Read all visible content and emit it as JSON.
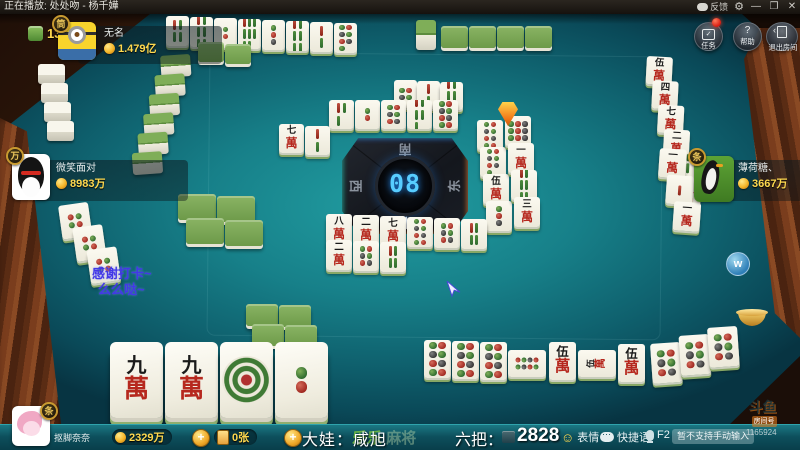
{
  "titlebar": {
    "now_playing": "正在播放: 处处吻 - 杨千嬅",
    "feedback_label": "反馈",
    "minimize": "—",
    "maximize": "❐",
    "close": "✕"
  },
  "menu_buttons": {
    "tasks": "任务",
    "help": "帮助",
    "help_icon": "?",
    "exit": "退出房间"
  },
  "tile_counter": "13",
  "players": {
    "top": {
      "badge": "筒",
      "name": "无名",
      "money": "1.479亿"
    },
    "left": {
      "badge": "万",
      "name": "微笑面对",
      "money": "8983万"
    },
    "right": {
      "badge": "条",
      "name": "薄荷糖、",
      "money": "3667万"
    },
    "bottom": {
      "badge": "条",
      "name": "抠脚奈奈",
      "money": "2329万",
      "cards": "0张"
    }
  },
  "center": {
    "timer": "08",
    "south": "南",
    "north": "北",
    "west": "西",
    "east": "东"
  },
  "chat": {
    "line1": "感谢打卡~",
    "line2": "么么哒~"
  },
  "bottom_bar": {
    "dealer": "大娃：咸旭",
    "round_label": "六把：",
    "round_value": "2828",
    "emoji": "表情",
    "quick": "快捷语",
    "mic_key": "F2",
    "input_placeholder": "暂不支持手动输入",
    "watermark_a": "乐乐",
    "watermark_b": "麻将"
  },
  "douyu": {
    "logo": "斗鱼",
    "room_label": "房间号",
    "room_number": "1165924"
  },
  "side_icons": {
    "w_label": "w"
  },
  "colors": {
    "money_text": "#ffd94f",
    "table": "#178089",
    "led": "#57cdff",
    "wood": "#7a3d1d",
    "chat_blue": "#4338e6",
    "tile_back_green": "#6d9a49"
  },
  "tile_groups": [
    {
      "name": "top-meld-row",
      "x": 166,
      "y": 16,
      "tw": 23,
      "th": 30,
      "step": [
        24,
        1
      ],
      "style": "flat",
      "faces": [
        "s4",
        "s6",
        "t2",
        "s8",
        "t3",
        "s6",
        "s2",
        "t7"
      ]
    },
    {
      "name": "top-backs-small",
      "x": 198,
      "y": 42,
      "tw": 26,
      "th": 20,
      "step": [
        27,
        2
      ],
      "style": "backflat",
      "faces": [
        "back",
        "back"
      ]
    },
    {
      "name": "top-stand-back",
      "x": 416,
      "y": 20,
      "tw": 20,
      "th": 30,
      "step": [
        0,
        0
      ],
      "style": "backstand",
      "faces": [
        "back"
      ]
    },
    {
      "name": "top-flat-backs",
      "x": 441,
      "y": 26,
      "tw": 27,
      "th": 22,
      "step": [
        28,
        0
      ],
      "style": "backflat",
      "faces": [
        "back",
        "back",
        "back",
        "back"
      ]
    },
    {
      "name": "left-white-wall",
      "x": 38,
      "y": 64,
      "tw": 27,
      "th": 20,
      "step": [
        3,
        19
      ],
      "style": "standwhite",
      "faces": [
        "back",
        "back",
        "back",
        "back"
      ]
    },
    {
      "name": "left-wall",
      "x": 160,
      "y": 56,
      "tw": 30,
      "th": 22,
      "step": [
        -7,
        19
      ],
      "style": "backstand",
      "faces": [
        "back",
        "back",
        "back",
        "back",
        "back",
        "back"
      ],
      "rot": -4
    },
    {
      "name": "left-melds",
      "x": 58,
      "y": 206,
      "tw": 30,
      "th": 34,
      "step": [
        11,
        24
      ],
      "style": "flat",
      "faces": [
        "f",
        "f",
        "f"
      ],
      "rot": -8
    },
    {
      "name": "left-green-a",
      "x": 178,
      "y": 194,
      "tw": 38,
      "th": 26,
      "step": [
        39,
        2
      ],
      "style": "backflat",
      "faces": [
        "back",
        "back"
      ]
    },
    {
      "name": "left-green-b",
      "x": 186,
      "y": 218,
      "tw": 38,
      "th": 26,
      "step": [
        39,
        2
      ],
      "style": "backflat",
      "faces": [
        "back",
        "back"
      ]
    },
    {
      "name": "bottom-green-a",
      "x": 246,
      "y": 304,
      "tw": 32,
      "th": 22,
      "step": [
        33,
        1
      ],
      "style": "backflat",
      "faces": [
        "back",
        "back"
      ]
    },
    {
      "name": "bottom-green-b",
      "x": 252,
      "y": 324,
      "tw": 32,
      "th": 22,
      "step": [
        33,
        1
      ],
      "style": "backflat",
      "faces": [
        "back",
        "back"
      ]
    },
    {
      "name": "top-discards-a",
      "x": 394,
      "y": 80,
      "tw": 23,
      "th": 28,
      "step": [
        23,
        1
      ],
      "style": "flat",
      "faces": [
        "t4",
        "s2",
        "s5"
      ]
    },
    {
      "name": "top-discards-b",
      "x": 329,
      "y": 100,
      "tw": 25,
      "th": 29,
      "step": [
        26,
        0
      ],
      "style": "flat",
      "faces": [
        "s3",
        "t2",
        "t6",
        "s5",
        "t8"
      ]
    },
    {
      "name": "mid-left-pair",
      "x": 279,
      "y": 124,
      "tw": 25,
      "th": 29,
      "step": [
        26,
        2
      ],
      "style": "flat",
      "faces": [
        "w7",
        "s2"
      ]
    },
    {
      "name": "center-right-col-a",
      "x": 477,
      "y": 120,
      "tw": 26,
      "th": 30,
      "step": [
        3,
        27
      ],
      "style": "flat",
      "faces": [
        "t8",
        "t7",
        "w5",
        "t3"
      ]
    },
    {
      "name": "center-right-col-b",
      "x": 505,
      "y": 116,
      "tw": 26,
      "th": 30,
      "step": [
        3,
        27
      ],
      "style": "flat",
      "faces": [
        "t9",
        "w1",
        "s6",
        "w3"
      ]
    },
    {
      "name": "right-river",
      "x": 647,
      "y": 56,
      "tw": 26,
      "th": 28,
      "step": [
        7,
        24
      ],
      "style": "flat",
      "faces": [
        "w5",
        "w4",
        "w7",
        "w2",
        "s8",
        "w6"
      ],
      "rot": 3
    },
    {
      "name": "right-river-low",
      "x": 660,
      "y": 148,
      "tw": 27,
      "th": 29,
      "step": [
        9,
        26
      ],
      "style": "flat",
      "faces": [
        "w1",
        "s1",
        "w1"
      ],
      "rot": 4
    },
    {
      "name": "below-center-a",
      "x": 326,
      "y": 214,
      "tw": 26,
      "th": 30,
      "step": [
        27,
        1
      ],
      "style": "flat",
      "faces": [
        "w8",
        "w2",
        "w7",
        "t8",
        "t6",
        "s4"
      ]
    },
    {
      "name": "below-center-b",
      "x": 326,
      "y": 240,
      "tw": 26,
      "th": 30,
      "step": [
        27,
        1
      ],
      "style": "flat",
      "faces": [
        "w2",
        "t6",
        "s4"
      ]
    },
    {
      "name": "hand",
      "x": 110,
      "y": 342,
      "tw": 53,
      "th": 76,
      "step": [
        55,
        0
      ],
      "style": "hand",
      "faces": [
        "w9",
        "w9",
        "t1",
        "t2"
      ]
    },
    {
      "name": "meld-t8",
      "x": 424,
      "y": 340,
      "tw": 27,
      "th": 38,
      "step": [
        28,
        1
      ],
      "style": "meld",
      "faces": [
        "t8",
        "t8",
        "t8"
      ]
    },
    {
      "name": "meld-t8-side",
      "x": 508,
      "y": 350,
      "tw": 38,
      "th": 27,
      "step": [
        0,
        0
      ],
      "style": "meldside",
      "faces": [
        "t8"
      ]
    },
    {
      "name": "meld-w5-a",
      "x": 549,
      "y": 342,
      "tw": 27,
      "th": 38,
      "step": [
        0,
        0
      ],
      "style": "meld",
      "faces": [
        "w5"
      ]
    },
    {
      "name": "meld-w5-side",
      "x": 578,
      "y": 350,
      "tw": 38,
      "th": 27,
      "step": [
        0,
        0
      ],
      "style": "meldside",
      "faces": [
        "w5"
      ]
    },
    {
      "name": "meld-w5-b",
      "x": 618,
      "y": 344,
      "tw": 27,
      "th": 38,
      "step": [
        0,
        0
      ],
      "style": "meld",
      "faces": [
        "w5"
      ]
    },
    {
      "name": "right-flat-meld",
      "x": 650,
      "y": 344,
      "tw": 30,
      "th": 40,
      "step": [
        29,
        -6
      ],
      "style": "flat",
      "faces": [
        "t6",
        "t6",
        "t6"
      ],
      "rot": -4
    }
  ]
}
